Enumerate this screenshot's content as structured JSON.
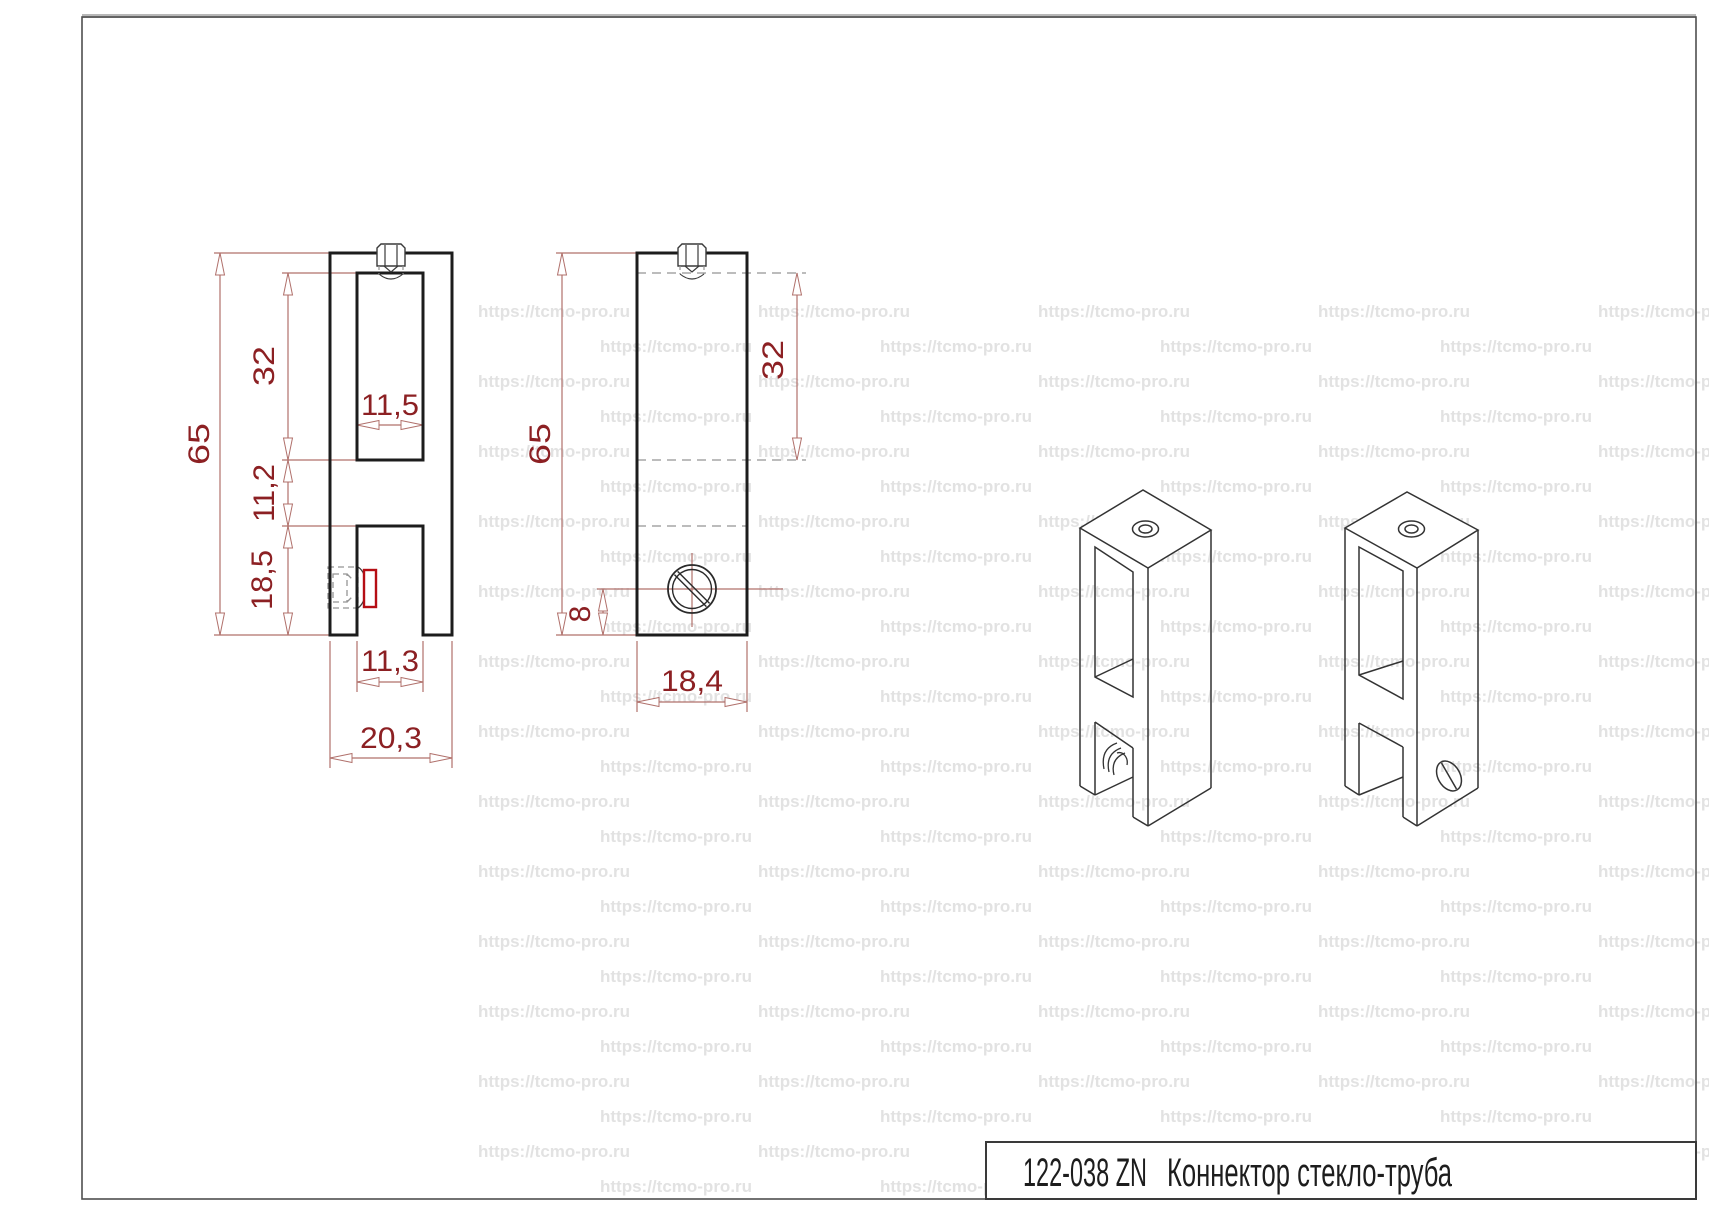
{
  "title_block": {
    "code": "122-038 ZN",
    "name": "Коннектор стекло-труба"
  },
  "watermark": {
    "text": "https://tcmo-pro.ru",
    "color": "#e2e2e2",
    "font_size": 17,
    "x_start_even": 478,
    "x_start_odd": 600,
    "col_pitch": 280,
    "y_start": 302,
    "row_pitch": 35,
    "rows": 26,
    "right_limit": 1709
  },
  "views": {
    "front": {
      "dims": {
        "height": "65",
        "slot_depth": "32",
        "middle": "11,2",
        "lower": "18,5",
        "slot_width": "11,5",
        "lower_slot_width": "11,3",
        "width": "20,3"
      }
    },
    "side": {
      "dims": {
        "height": "65",
        "slot_depth": "32",
        "screw_offset": "8",
        "width": "18,4"
      }
    }
  },
  "colors": {
    "outline": "#1c1c1c",
    "thin_line": "#3a3a3a",
    "hidden_line": "#949494",
    "dimension_line": "#b0706b",
    "dimension_text": "#8c2023",
    "highlight": "#b50e14",
    "frame": "#4f4f4f",
    "frame_top": "#b8b8b8"
  }
}
